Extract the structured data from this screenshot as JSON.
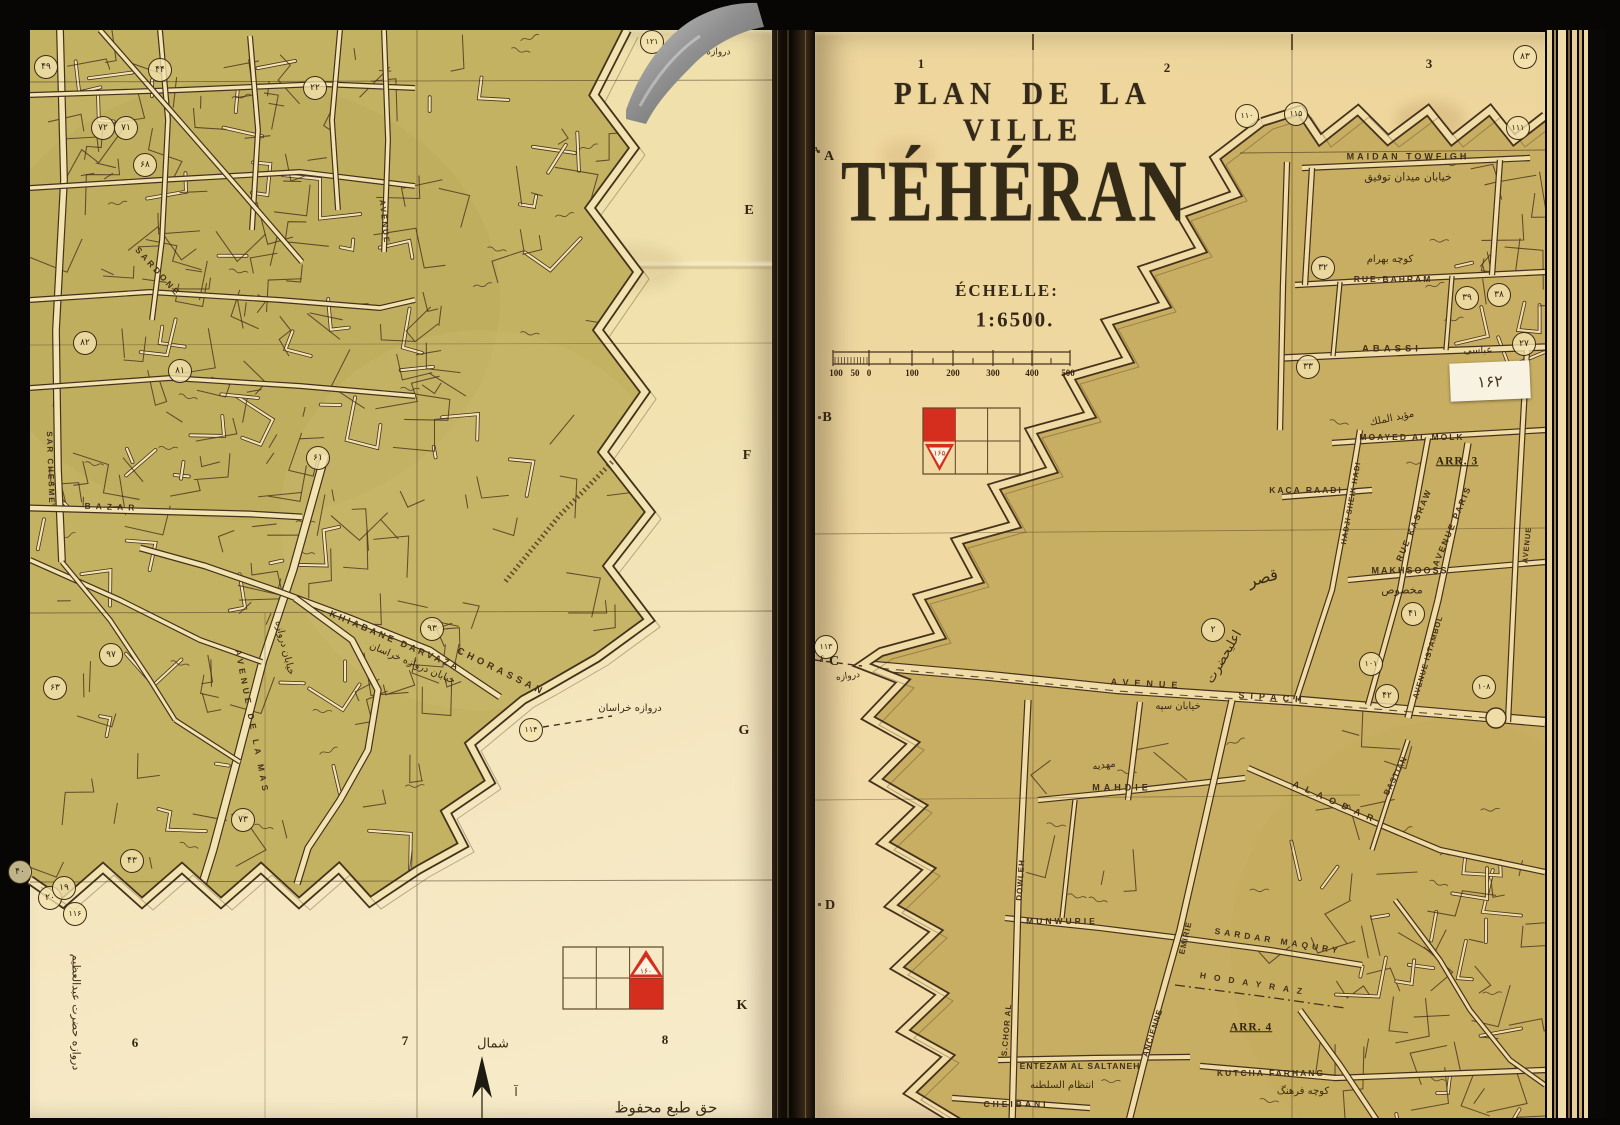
{
  "colors": {
    "paper": "#f0dca4",
    "olive": "#c5b163",
    "ink": "#46321c",
    "red": "#d52e1e",
    "ribbon": "#9a9a9a"
  },
  "spread": {
    "left_page": {
      "row_letters": [
        {
          "t": "E",
          "x": 749,
          "y": 211
        },
        {
          "t": "F",
          "x": 747,
          "y": 456
        },
        {
          "t": "G",
          "x": 744,
          "y": 731
        },
        {
          "t": "K",
          "x": 742,
          "y": 1006
        }
      ],
      "col_numbers": [
        {
          "t": "6",
          "x": 135,
          "y": 1043
        },
        {
          "t": "7",
          "x": 405,
          "y": 1041
        },
        {
          "t": "8",
          "x": 665,
          "y": 1040
        }
      ],
      "legend_triangle_value": "۱۶۰",
      "labels": [
        {
          "t": "KHIABANE DARVAZA",
          "x": 395,
          "y": 641,
          "rot": 23,
          "ls": 3,
          "fs": 9
        },
        {
          "t": "CHORASSAN",
          "x": 501,
          "y": 672,
          "rot": 26,
          "ls": 4,
          "fs": 9.5
        },
        {
          "t": "خيابان دروازه خراسان",
          "x": 412,
          "y": 664,
          "rot": 23,
          "fs": 10,
          "cls": "fa"
        },
        {
          "t": "دروازه خراسان",
          "x": 630,
          "y": 709,
          "fs": 10,
          "cls": "fa"
        },
        {
          "t": "AVENUE DE LA MAS",
          "x": 252,
          "y": 722,
          "rot": 79,
          "ls": 4,
          "fs": 8.5
        },
        {
          "t": "خيابان دروازه",
          "x": 284,
          "y": 648,
          "rot": 76,
          "fs": 10,
          "cls": "fa"
        },
        {
          "t": "SARDONE",
          "x": 158,
          "y": 272,
          "rot": 48,
          "ls": 3,
          "fs": 8.5
        },
        {
          "t": "BAZAR",
          "x": 112,
          "y": 507,
          "rot": 2,
          "ls": 5,
          "fs": 8.5
        },
        {
          "t": "SAR CHESME",
          "x": 50,
          "y": 468,
          "rot": 88,
          "ls": 2,
          "fs": 8
        },
        {
          "t": "AVENUE",
          "x": 384,
          "y": 222,
          "rot": 84,
          "ls": 2,
          "fs": 8
        },
        {
          "t": "دروازه دولاب",
          "x": 706,
          "y": 53,
          "fs": 9,
          "cls": "fa"
        },
        {
          "t": "دروازه حضرت عبدالعظيم",
          "x": 76,
          "y": 1012,
          "rot": 90,
          "fs": 11,
          "cls": "fa"
        },
        {
          "t": "شمال",
          "x": 493,
          "y": 1044,
          "fs": 13,
          "cls": "fa"
        },
        {
          "t": "آ",
          "x": 516,
          "y": 1092,
          "fs": 12,
          "cls": "fa"
        },
        {
          "t": "حق طبع محفوظ",
          "x": 666,
          "y": 1108,
          "fs": 15,
          "cls": "fa"
        }
      ],
      "circled": [
        {
          "t": "۴۹",
          "x": 46,
          "y": 67
        },
        {
          "t": "۴۴",
          "x": 160,
          "y": 70
        },
        {
          "t": "۲۲",
          "x": 315,
          "y": 88
        },
        {
          "t": "۷۲",
          "x": 103,
          "y": 128
        },
        {
          "t": "۷۱",
          "x": 126,
          "y": 128
        },
        {
          "t": "۶۸",
          "x": 145,
          "y": 165
        },
        {
          "t": "۸۲",
          "x": 85,
          "y": 343
        },
        {
          "t": "۸۱",
          "x": 180,
          "y": 371
        },
        {
          "t": "۶۱",
          "x": 318,
          "y": 458
        },
        {
          "t": "۹۳",
          "x": 432,
          "y": 629
        },
        {
          "t": "۹۷",
          "x": 111,
          "y": 655
        },
        {
          "t": "۶۳",
          "x": 55,
          "y": 688
        },
        {
          "t": "۱۱۴",
          "x": 531,
          "y": 730
        },
        {
          "t": "۷۳",
          "x": 243,
          "y": 820
        },
        {
          "t": "۴۳",
          "x": 132,
          "y": 861
        },
        {
          "t": "۲۰",
          "x": 50,
          "y": 898
        },
        {
          "t": "۱۱۶",
          "x": 75,
          "y": 914
        },
        {
          "t": "۴۰",
          "x": 20,
          "y": 872
        },
        {
          "t": "۱۹",
          "x": 64,
          "y": 888
        },
        {
          "t": "۱۲۱",
          "x": 652,
          "y": 42
        }
      ]
    },
    "right_page": {
      "title": "PLAN DE LA VILLE",
      "city": "TÉHÉRAN",
      "scale_caption": "ÉCHELLE:",
      "scale_ratio": "1:6500.",
      "scale_numbers": [
        {
          "t": "100",
          "x": 836
        },
        {
          "t": "50",
          "x": 855
        },
        {
          "t": "0",
          "x": 869
        },
        {
          "t": "100",
          "x": 912
        },
        {
          "t": "200",
          "x": 953
        },
        {
          "t": "300",
          "x": 993
        },
        {
          "t": "400",
          "x": 1032
        },
        {
          "t": "500",
          "x": 1068
        }
      ],
      "col_numbers": [
        {
          "t": "1",
          "x": 921,
          "y": 64
        },
        {
          "t": "2",
          "x": 1167,
          "y": 68
        },
        {
          "t": "3",
          "x": 1429,
          "y": 64
        }
      ],
      "row_letters": [
        {
          "t": "A",
          "x": 829,
          "y": 157
        },
        {
          "t": "A",
          "x": 816,
          "y": 150,
          "fs": 7
        },
        {
          "t": "B",
          "x": 827,
          "y": 418
        },
        {
          "t": "C",
          "x": 834,
          "y": 662
        },
        {
          "t": "c",
          "x": 822,
          "y": 657,
          "fs": 7
        },
        {
          "t": "D",
          "x": 830,
          "y": 906
        }
      ],
      "legend_triangle_value": "۱۶۵",
      "sticker": "۱۶۲",
      "labels": [
        {
          "t": "MAIDAN TOWFIGH",
          "x": 1408,
          "y": 157,
          "ls": 3,
          "fs": 9
        },
        {
          "t": "خيابان ميدان توفيق",
          "x": 1408,
          "y": 177,
          "fs": 11,
          "cls": "fa"
        },
        {
          "t": "كوچه بهرام",
          "x": 1390,
          "y": 260,
          "fs": 10,
          "cls": "fa"
        },
        {
          "t": "RUE·BAHRAM",
          "x": 1393,
          "y": 279,
          "ls": 2,
          "fs": 8.5
        },
        {
          "t": "ABASSI",
          "x": 1392,
          "y": 349,
          "ls": 4,
          "fs": 9.5
        },
        {
          "t": "عباسى",
          "x": 1478,
          "y": 351,
          "fs": 10,
          "cls": "fa"
        },
        {
          "t": "MOAYED AL MOLK",
          "x": 1412,
          "y": 437,
          "ls": 2,
          "fs": 8.5
        },
        {
          "t": "مؤيد الملك",
          "x": 1392,
          "y": 419,
          "rot": -12,
          "fs": 10,
          "cls": "fa"
        },
        {
          "t": "ARR. 3",
          "x": 1457,
          "y": 462,
          "fs": 11.5,
          "cls": "arr"
        },
        {
          "t": "KACA RAADI",
          "x": 1306,
          "y": 490,
          "ls": 2,
          "fs": 8.5
        },
        {
          "t": "HADJI SHEIK HADI",
          "x": 1351,
          "y": 503,
          "rot": -80,
          "ls": 1,
          "fs": 7.5
        },
        {
          "t": "RUE KASRAW",
          "x": 1414,
          "y": 525,
          "rot": -67,
          "ls": 2,
          "fs": 8.5
        },
        {
          "t": "AVENUE PARIS",
          "x": 1452,
          "y": 526,
          "rot": -67,
          "ls": 2,
          "fs": 8.5
        },
        {
          "t": "AVENUE",
          "x": 1527,
          "y": 545,
          "rot": -84,
          "ls": 1,
          "fs": 7.5
        },
        {
          "t": "MAKHSOOSS",
          "x": 1410,
          "y": 571,
          "ls": 2,
          "fs": 9
        },
        {
          "t": "مخصوص",
          "x": 1402,
          "y": 590,
          "fs": 11,
          "cls": "fa"
        },
        {
          "t": "قصر",
          "x": 1263,
          "y": 578,
          "rot": -15,
          "fs": 16,
          "cls": "fa"
        },
        {
          "t": "AVENUE ISTAMBOL",
          "x": 1428,
          "y": 657,
          "rot": -73,
          "ls": 1,
          "fs": 7.5
        },
        {
          "t": "AVENUE",
          "x": 1147,
          "y": 684,
          "rot": 3,
          "ls": 6,
          "fs": 9
        },
        {
          "t": "SIPACH",
          "x": 1273,
          "y": 698,
          "rot": 4,
          "ls": 6,
          "fs": 9
        },
        {
          "t": "خيابان سپه",
          "x": 1178,
          "y": 707,
          "fs": 10,
          "cls": "fa"
        },
        {
          "t": "اعليحضرت",
          "x": 1224,
          "y": 657,
          "rot": -60,
          "fs": 13,
          "cls": "fa"
        },
        {
          "t": "دروازه",
          "x": 848,
          "y": 677,
          "rot": -8,
          "fs": 9,
          "cls": "fa"
        },
        {
          "t": "MAHDIE",
          "x": 1122,
          "y": 788,
          "ls": 4,
          "fs": 9
        },
        {
          "t": "مهديه",
          "x": 1104,
          "y": 766,
          "rot": -8,
          "fs": 10,
          "cls": "fa"
        },
        {
          "t": "ALAODAR",
          "x": 1336,
          "y": 803,
          "rot": 24,
          "ls": 7,
          "fs": 9
        },
        {
          "t": "BASTIAN",
          "x": 1396,
          "y": 776,
          "rot": -63,
          "ls": 1,
          "fs": 8
        },
        {
          "t": "MUNWURIE",
          "x": 1062,
          "y": 921,
          "ls": 3,
          "fs": 8.5
        },
        {
          "t": "DOWLEH",
          "x": 1021,
          "y": 880,
          "rot": -86,
          "ls": 1,
          "fs": 8
        },
        {
          "t": "S.CHOR AL",
          "x": 1007,
          "y": 1030,
          "rot": -85,
          "ls": 1,
          "fs": 8
        },
        {
          "t": "SARDAR MAQURY",
          "x": 1278,
          "y": 941,
          "rot": 9,
          "ls": 4,
          "fs": 8.5
        },
        {
          "t": "HODAYRAZ",
          "x": 1255,
          "y": 984,
          "rot": 9,
          "ls": 8,
          "fs": 8.5
        },
        {
          "t": "ARR. 4",
          "x": 1251,
          "y": 1028,
          "fs": 11.5,
          "cls": "arr"
        },
        {
          "t": "EMIRIE",
          "x": 1186,
          "y": 938,
          "rot": -77,
          "ls": 1,
          "fs": 8
        },
        {
          "t": "ANCIENNE",
          "x": 1153,
          "y": 1033,
          "rot": -72,
          "ls": 1,
          "fs": 8
        },
        {
          "t": "ENTEZAM AL SALTANEH",
          "x": 1080,
          "y": 1066,
          "ls": 1,
          "fs": 8.5
        },
        {
          "t": "انتظام السلطنه",
          "x": 1062,
          "y": 1086,
          "fs": 10,
          "cls": "fa"
        },
        {
          "t": "KUTCHA FARHANG",
          "x": 1271,
          "y": 1073,
          "ls": 2,
          "fs": 8.5
        },
        {
          "t": "كوچه فرهنگ",
          "x": 1303,
          "y": 1092,
          "fs": 10,
          "cls": "fa"
        },
        {
          "t": "CHEIBANI",
          "x": 1016,
          "y": 1104,
          "ls": 3,
          "fs": 8.5
        }
      ],
      "circled": [
        {
          "t": "۱۱۰",
          "x": 1247,
          "y": 116
        },
        {
          "t": "۱۱۵",
          "x": 1296,
          "y": 114
        },
        {
          "t": "۸۳",
          "x": 1525,
          "y": 57
        },
        {
          "t": "۱۱۱",
          "x": 1518,
          "y": 128
        },
        {
          "t": "۳۲",
          "x": 1323,
          "y": 268
        },
        {
          "t": "۳۹",
          "x": 1467,
          "y": 298
        },
        {
          "t": "۳۸",
          "x": 1499,
          "y": 295
        },
        {
          "t": "۲۷",
          "x": 1524,
          "y": 344
        },
        {
          "t": "۳۳",
          "x": 1308,
          "y": 367
        },
        {
          "t": "۴۱",
          "x": 1413,
          "y": 614
        },
        {
          "t": "۱۰۱",
          "x": 1371,
          "y": 664
        },
        {
          "t": "۴۲",
          "x": 1387,
          "y": 696
        },
        {
          "t": "۱۰۸",
          "x": 1484,
          "y": 687
        },
        {
          "t": "۱۱۳",
          "x": 826,
          "y": 647
        },
        {
          "t": "۲",
          "x": 1213,
          "y": 630
        }
      ]
    }
  }
}
